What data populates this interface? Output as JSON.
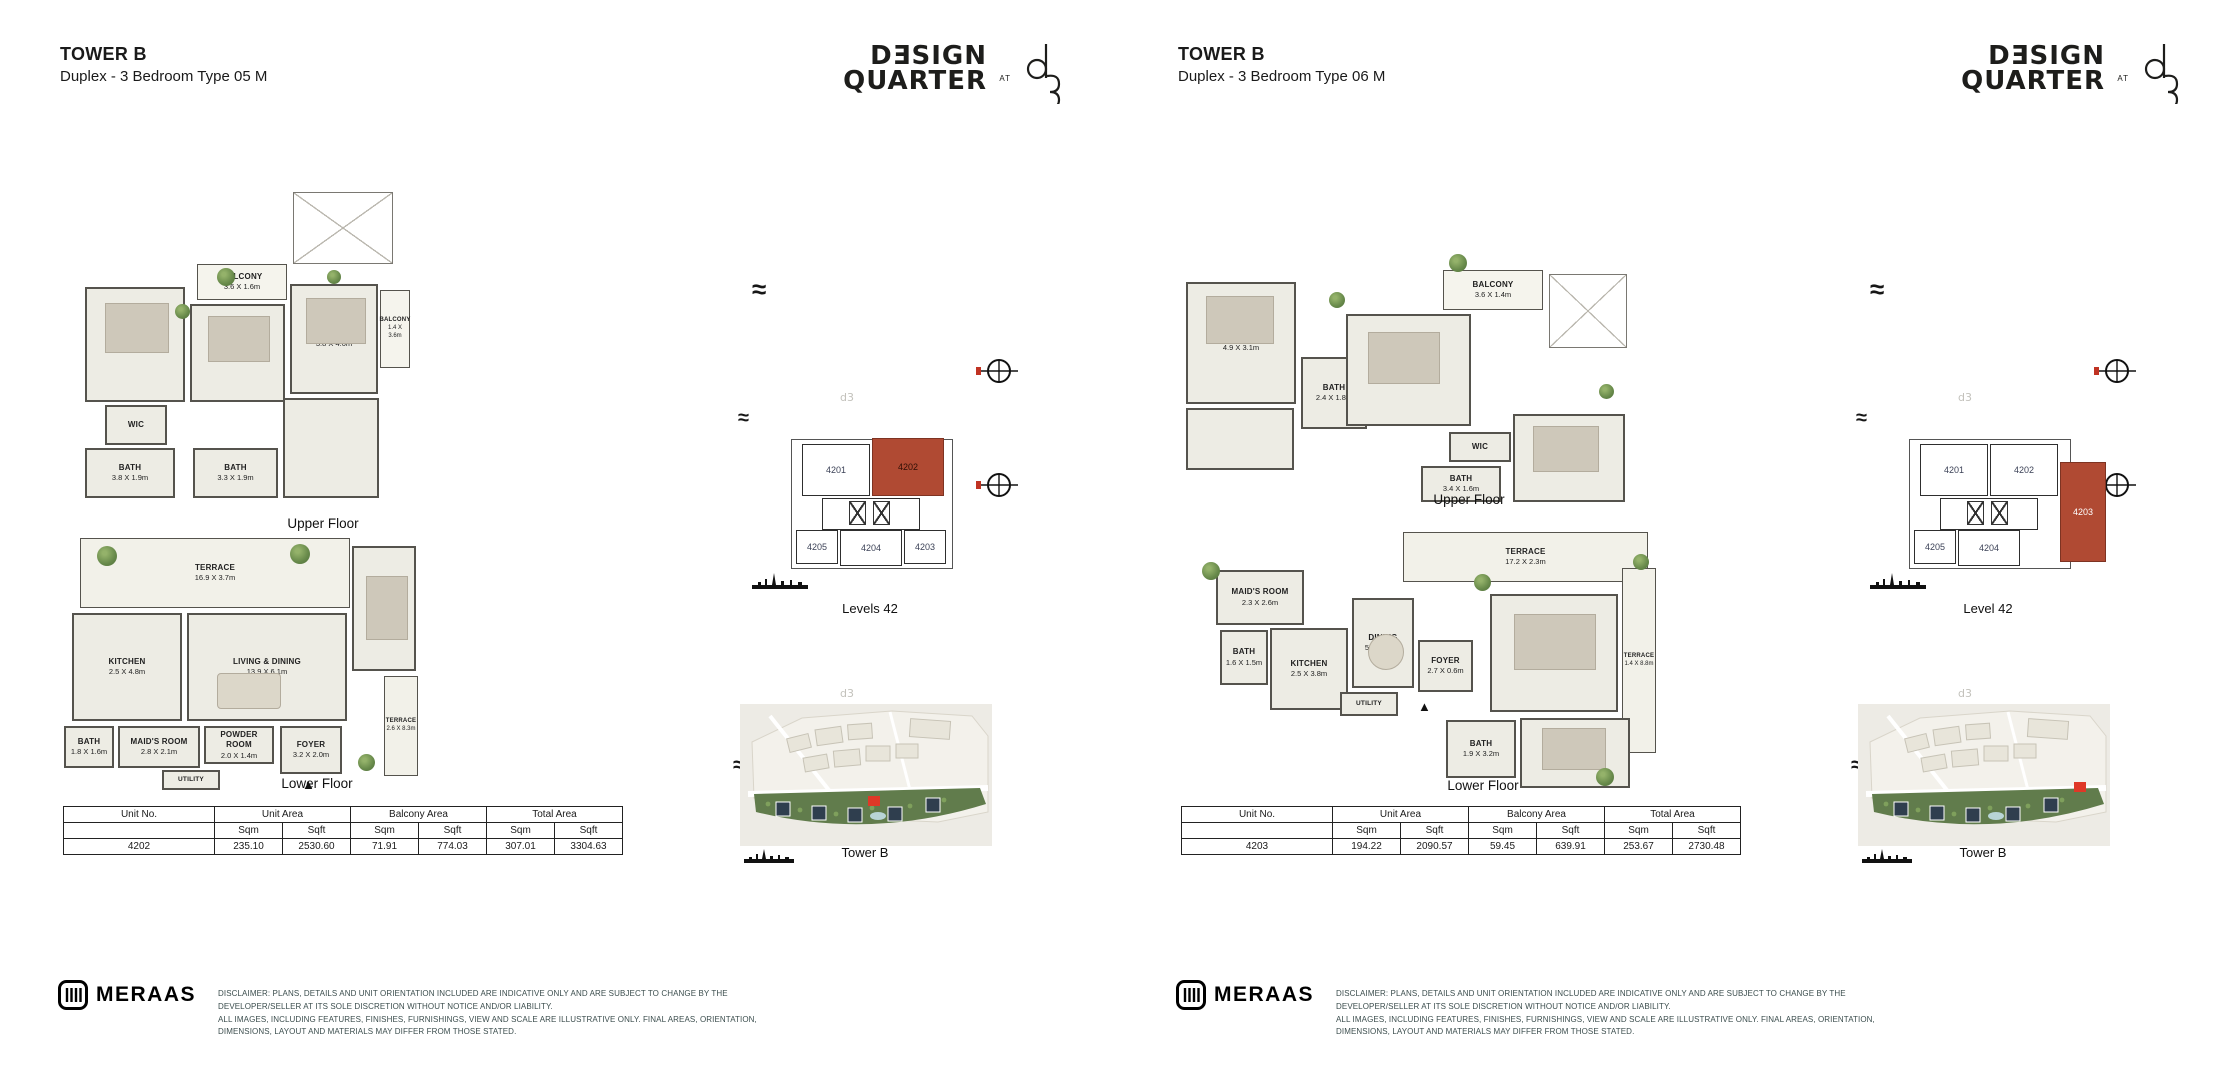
{
  "brand_logo": {
    "line1": "DƎSIGN",
    "line2": "QUARTER",
    "at": "AT",
    "monogram": "d3"
  },
  "icons": {
    "wave": "≈",
    "entry_marker": "▲",
    "d3_watermark": "d3"
  },
  "colors": {
    "highlight_unit": "#b04a33",
    "map_highlight": "#df3827",
    "wall": "#55534d",
    "room_fill": "#edece4",
    "green_band": "#617c4c",
    "disclaimer_text": "#3c4e4e"
  },
  "footer": {
    "brand": "MERAAS",
    "disclaimer_line1": "DISCLAIMER: PLANS, DETAILS AND UNIT ORIENTATION INCLUDED ARE INDICATIVE ONLY AND ARE SUBJECT TO CHANGE BY THE DEVELOPER/SELLER AT ITS SOLE DISCRETION WITHOUT NOTICE AND/OR LIABILITY.",
    "disclaimer_line2": "ALL IMAGES, INCLUDING FEATURES, FINISHES, FURNISHINGS, VIEW AND SCALE ARE ILLUSTRATIVE ONLY. FINAL AREAS, ORIENTATION, DIMENSIONS, LAYOUT AND MATERIALS MAY DIFFER FROM THOSE STATED."
  },
  "pages": [
    {
      "title": "TOWER B",
      "subtitle": "Duplex - 3 Bedroom Type 05 M",
      "plans": {
        "upper": {
          "caption": "Upper Floor",
          "rooms": [
            {
              "name": "BALCONY",
              "dim": "3.6 X 1.6m"
            },
            {
              "name": "BEDROOM",
              "dim": "3.8 X 4.7m"
            },
            {
              "name": "BEDROOM",
              "dim": "4.3 X 3.3m"
            },
            {
              "name": "BEDROOM",
              "dim": "3.8 X 4.0m"
            },
            {
              "name": "BALCONY",
              "dim": "1.4 X 3.6m"
            },
            {
              "name": "WIC",
              "dim": ""
            },
            {
              "name": "BATH",
              "dim": "3.8 X 1.9m"
            },
            {
              "name": "BATH",
              "dim": "3.3 X 1.9m"
            }
          ]
        },
        "lower": {
          "caption": "Lower Floor",
          "rooms": [
            {
              "name": "TERRACE",
              "dim": "16.9 X 3.7m"
            },
            {
              "name": "KITCHEN",
              "dim": "2.5 X 4.8m"
            },
            {
              "name": "LIVING & DINING",
              "dim": "13.9 X 6.1m"
            },
            {
              "name": "TERRACE",
              "dim": "2.6 X 8.3m"
            },
            {
              "name": "BATH",
              "dim": "1.8 X 1.6m"
            },
            {
              "name": "MAID'S ROOM",
              "dim": "2.8 X 2.1m"
            },
            {
              "name": "POWDER ROOM",
              "dim": "2.0 X 1.4m"
            },
            {
              "name": "UTILITY",
              "dim": ""
            },
            {
              "name": "FOYER",
              "dim": "3.2 X 2.0m"
            }
          ]
        }
      },
      "key_plan": {
        "caption": "Levels 42",
        "u1": "4201",
        "u2": "4202",
        "u3": "4205",
        "u4": "4204",
        "u5": "4203",
        "highlighted": "4202"
      },
      "site_plan": {
        "caption": "Tower B"
      },
      "area_table": {
        "h_unit_no": "Unit No.",
        "h_unit_area": "Unit Area",
        "h_balcony_area": "Balcony Area",
        "h_total_area": "Total Area",
        "h_sqm": "Sqm",
        "h_sqft": "Sqft",
        "unit_no": "4202",
        "unit_sqm": "235.10",
        "unit_sqft": "2530.60",
        "balcony_sqm": "71.91",
        "balcony_sqft": "774.03",
        "total_sqm": "307.01",
        "total_sqft": "3304.63"
      }
    },
    {
      "title": "TOWER B",
      "subtitle": "Duplex - 3 Bedroom Type 06 M",
      "plans": {
        "upper": {
          "caption": "Upper Floor",
          "rooms": [
            {
              "name": "BEDROOM",
              "dim": "4.9 X 3.1m"
            },
            {
              "name": "BATH",
              "dim": "2.4 X 1.8m"
            },
            {
              "name": "LIVING",
              "dim": "5.3 X 4.9m"
            },
            {
              "name": "BALCONY",
              "dim": "3.6 X 1.4m"
            },
            {
              "name": "WIC",
              "dim": ""
            },
            {
              "name": "BATH",
              "dim": "3.4 X 1.6m"
            },
            {
              "name": "BEDROOM",
              "dim": "4.8 X 3.4m"
            }
          ]
        },
        "lower": {
          "caption": "Lower Floor",
          "rooms": [
            {
              "name": "TERRACE",
              "dim": "17.2 X 2.3m"
            },
            {
              "name": "MAID'S ROOM",
              "dim": "2.3 X 2.6m"
            },
            {
              "name": "KITCHEN",
              "dim": "2.5 X 3.8m"
            },
            {
              "name": "DINING",
              "dim": "5.0 X 4.1m"
            },
            {
              "name": "FOYER",
              "dim": "2.7 X 0.6m"
            },
            {
              "name": "LIVING",
              "dim": "6.7 X 4.2m"
            },
            {
              "name": "TERRACE",
              "dim": "1.4 X 8.8m"
            },
            {
              "name": "BATH",
              "dim": "1.6 X 1.5m"
            },
            {
              "name": "UTILITY",
              "dim": ""
            },
            {
              "name": "BATH",
              "dim": "1.9 X 3.2m"
            },
            {
              "name": "BEDROOM",
              "dim": "3.8 X 3.2m"
            }
          ]
        }
      },
      "key_plan": {
        "caption": "Level 42",
        "u1": "4201",
        "u2": "4202",
        "u3": "4205",
        "u4": "4204",
        "u5": "4203",
        "highlighted": "4203"
      },
      "site_plan": {
        "caption": "Tower B"
      },
      "area_table": {
        "h_unit_no": "Unit No.",
        "h_unit_area": "Unit Area",
        "h_balcony_area": "Balcony Area",
        "h_total_area": "Total Area",
        "h_sqm": "Sqm",
        "h_sqft": "Sqft",
        "unit_no": "4203",
        "unit_sqm": "194.22",
        "unit_sqft": "2090.57",
        "balcony_sqm": "59.45",
        "balcony_sqft": "639.91",
        "total_sqm": "253.67",
        "total_sqft": "2730.48"
      }
    }
  ]
}
